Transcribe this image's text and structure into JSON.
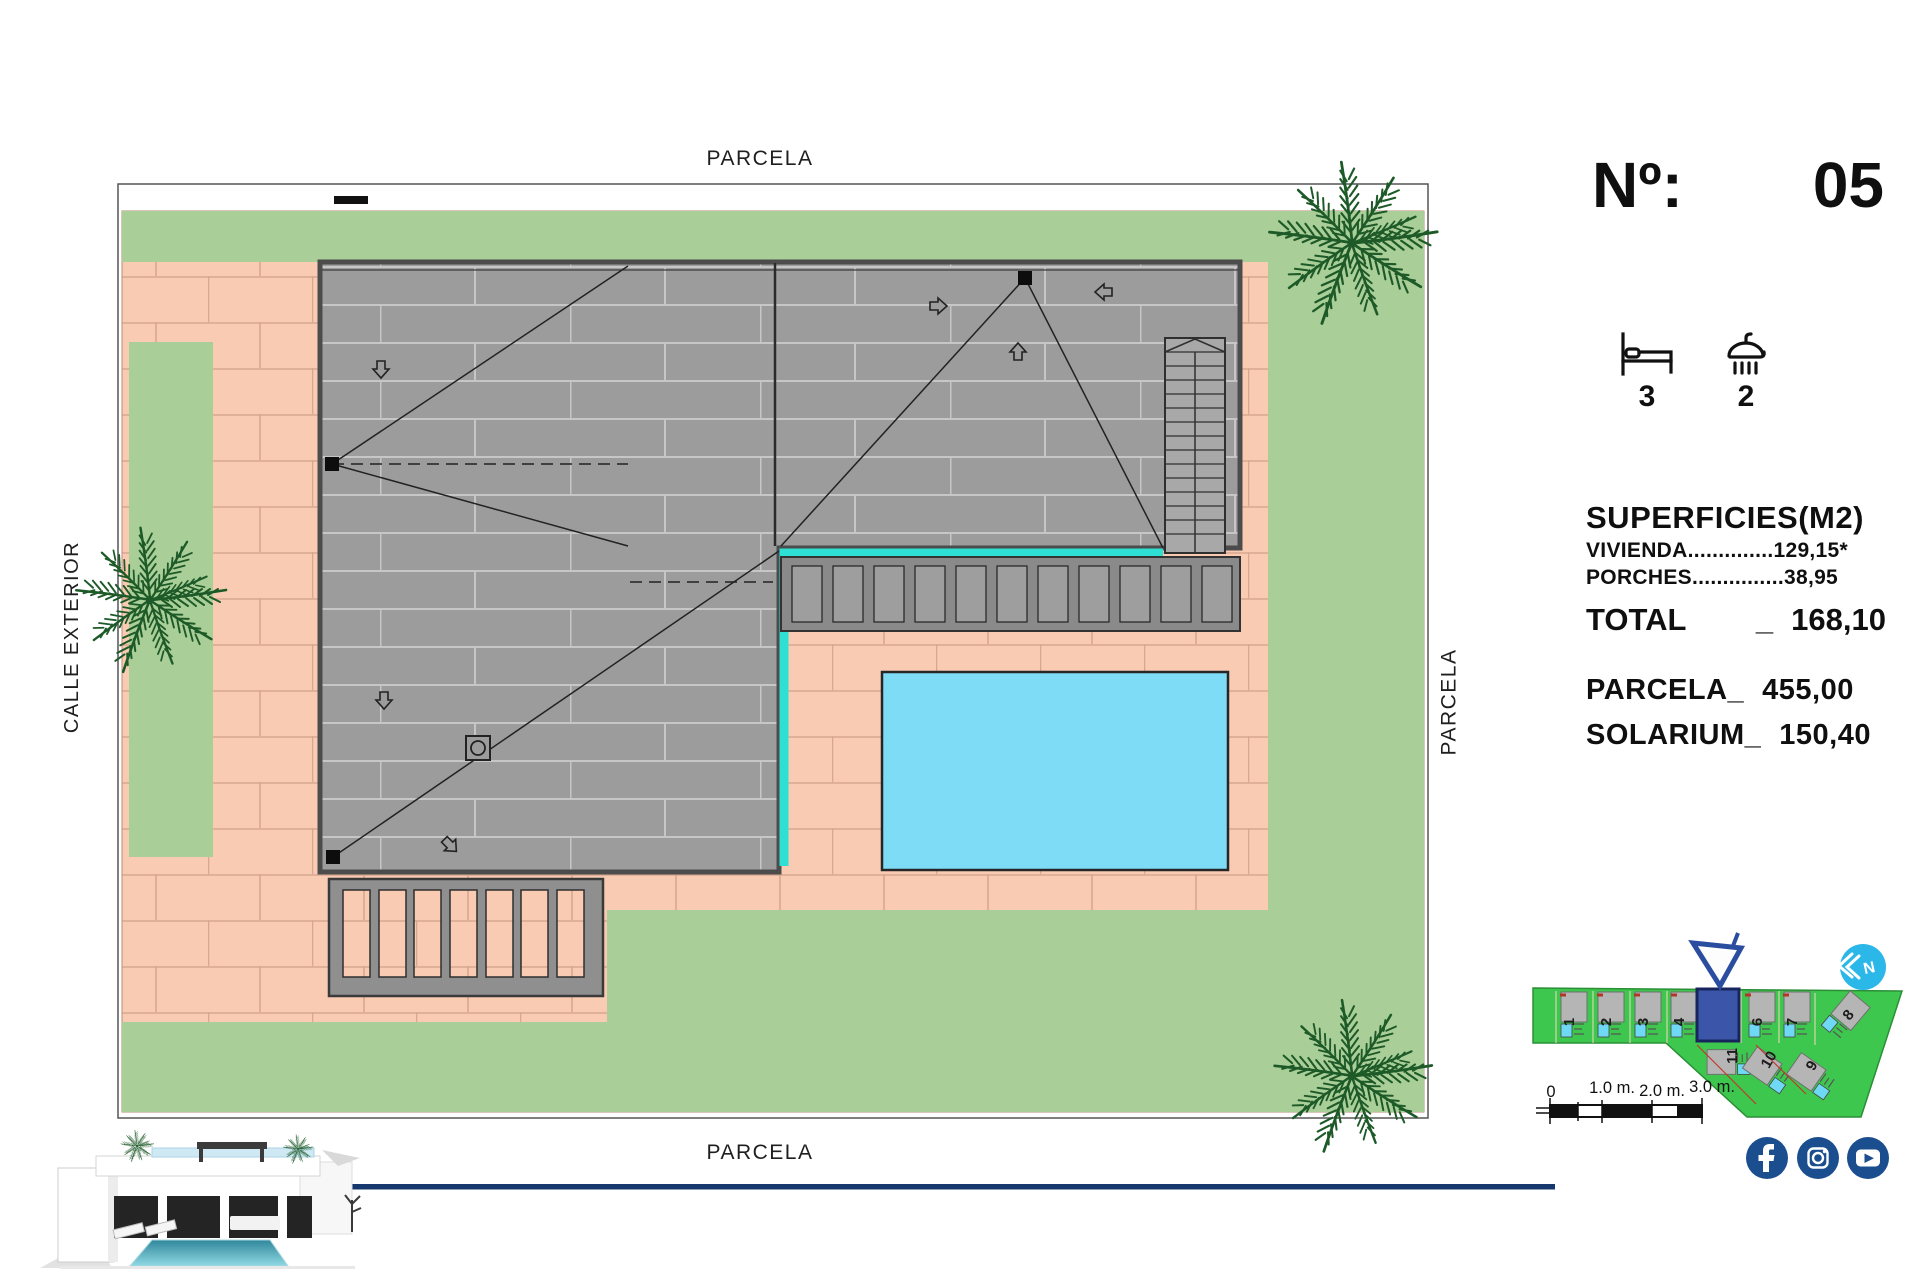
{
  "plan_labels": {
    "top": "PARCELA",
    "bottom": "PARCELA",
    "left": "CALLE EXTERIOR",
    "right": "PARCELA"
  },
  "info_panel": {
    "number_label": "Nº:",
    "number_value": "05",
    "bedrooms": "3",
    "bathrooms": "2",
    "surfaces_title": "SUPERFICIES(M2)",
    "surface_rows": [
      {
        "label": "VIVIENDA",
        "leader": "..............",
        "value": "129,15*"
      },
      {
        "label": "PORCHES",
        "leader": "...............",
        "value": "38,95"
      }
    ],
    "total_label": "TOTAL",
    "total_separator": "_",
    "total_value": "168,10",
    "parcela_label": "PARCELA_",
    "parcela_value": "455,00",
    "solarium_label": "SOLARIUM_",
    "solarium_value": "150,40"
  },
  "minimap": {
    "visible_plot_numbers": [
      "1",
      "2",
      "3",
      "4",
      "6",
      "7",
      "8",
      "9",
      "10",
      "11"
    ],
    "highlighted_plot": "5"
  },
  "compass": {
    "letter": "N"
  },
  "scale_bar": {
    "labels": [
      "0",
      "1.0 m.",
      "2.0 m.",
      "3.0 m."
    ]
  },
  "social_icons": [
    "facebook",
    "instagram",
    "youtube"
  ],
  "colors": {
    "lawn": "#a9ce98",
    "paving": "#facbb3",
    "paving_joint": "#d9a78f",
    "roof": "#9c9c9c",
    "roof_joint": "#c6c6c6",
    "roof_edge": "#4c4c4c",
    "pool": "#7fdcf7",
    "cyan_edge": "#2ee0d4",
    "minimap_green": "#3ec74e",
    "plot_highlight": "#3b55a8",
    "marker_blue": "#2b4da0",
    "social_blue": "#1b4e8e",
    "compass_cyan": "#2cb7e9",
    "divider_blue": "#17386f"
  }
}
